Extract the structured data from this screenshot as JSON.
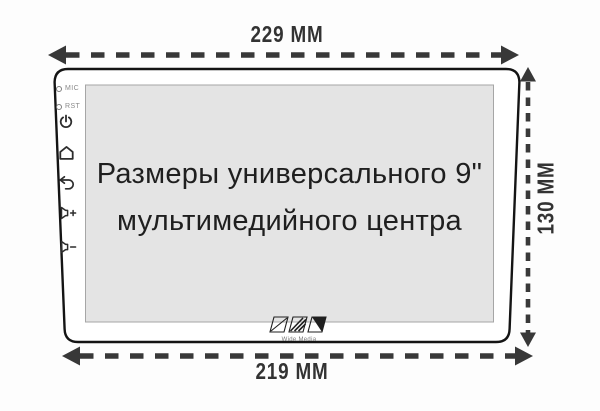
{
  "screen": {
    "title_line1": "Размеры универсального 9\"",
    "title_line2": "мультимедийного центра"
  },
  "dimensions": {
    "top_width": "229 MM",
    "bottom_width": "219 MM",
    "height": "130 MM"
  },
  "side_panel": {
    "mic_label": "MIC",
    "rst_label": "RST",
    "icons": [
      "power-icon",
      "home-icon",
      "back-icon",
      "volume-up-icon",
      "volume-down-icon"
    ]
  },
  "brand": {
    "name": "Wide Media"
  },
  "colors": {
    "outline": "#141414",
    "dimension_arrows": "#383838",
    "screen_fill": "#e4e4e4",
    "background": "#fdfdfd"
  }
}
